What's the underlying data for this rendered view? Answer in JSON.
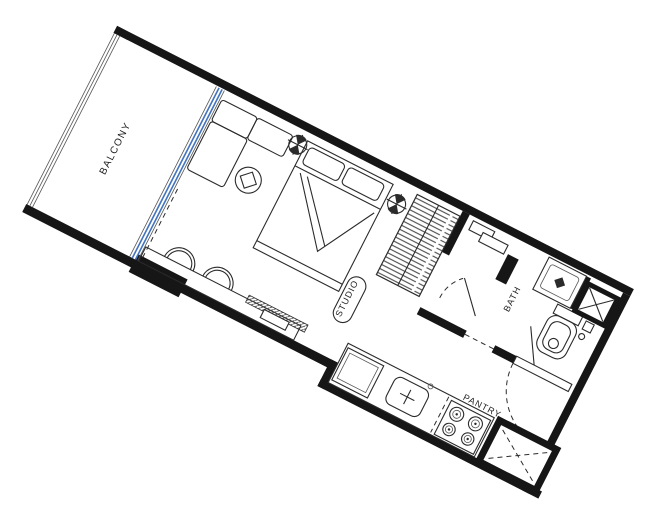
{
  "plan": {
    "type": "apartment-floor-plan",
    "unit": "studio-apartment",
    "rotation_note": "plan drawn rotated on sheet",
    "rooms": {
      "balcony": {
        "label": "BALCONY"
      },
      "studio": {
        "label": "STUDIO"
      },
      "bath": {
        "label": "BATH"
      },
      "pantry": {
        "label": "PANTRY"
      }
    },
    "icons": {
      "ceiling_light": "circle-with-cross",
      "shaft_solid": "box-with-x",
      "shaft_dashed": "box-with-dashed-x",
      "door_swing": "dashed-arc",
      "sink_cross": "plus",
      "faucet": "filled-diamond"
    },
    "colors": {
      "wall": "#161616",
      "line": "#2b2b2b",
      "muted_line": "#555555",
      "glass": "#4273bd",
      "text": "#1f1f1f",
      "background": "#ffffff"
    }
  }
}
